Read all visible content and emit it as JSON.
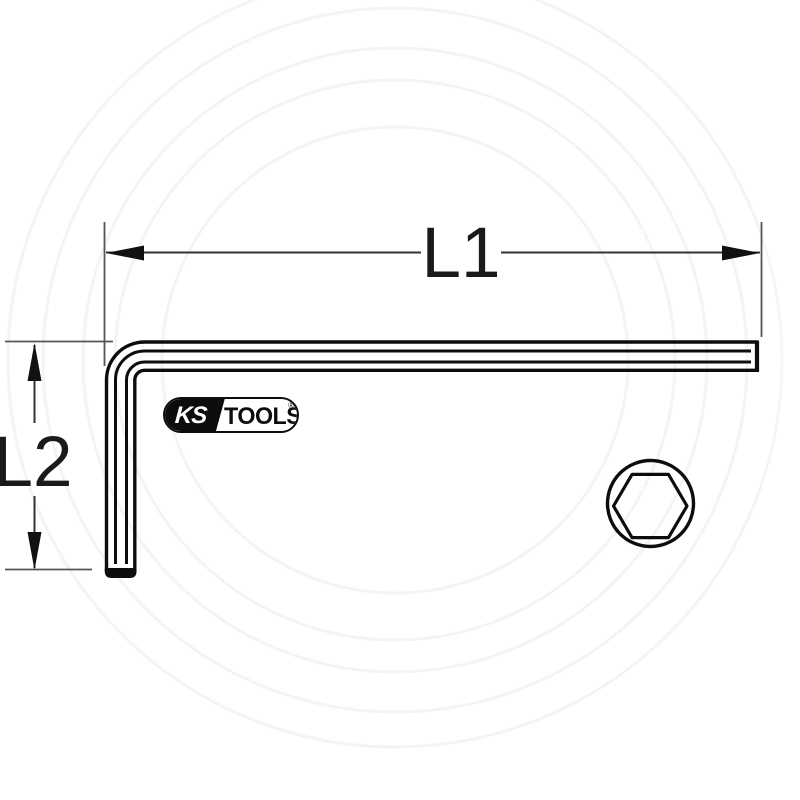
{
  "drawing": {
    "subject": "L-shaped hex key with dimension annotations",
    "dimensions": {
      "l1": {
        "label": "L1",
        "orientation": "horizontal"
      },
      "l2": {
        "label": "L2",
        "orientation": "vertical"
      }
    },
    "cross_section": {
      "shape": "hexagon inscribed in circle"
    },
    "colors": {
      "background": "#ffffff",
      "tool_outline": "#0d0d0d",
      "dimension_line": "#333333",
      "extension_line": "#555555",
      "label_text": "#1a1a1a",
      "watermark": "#000000"
    }
  },
  "logo": {
    "ks": "KS",
    "tools": "TOOLS",
    "registered": "®"
  }
}
